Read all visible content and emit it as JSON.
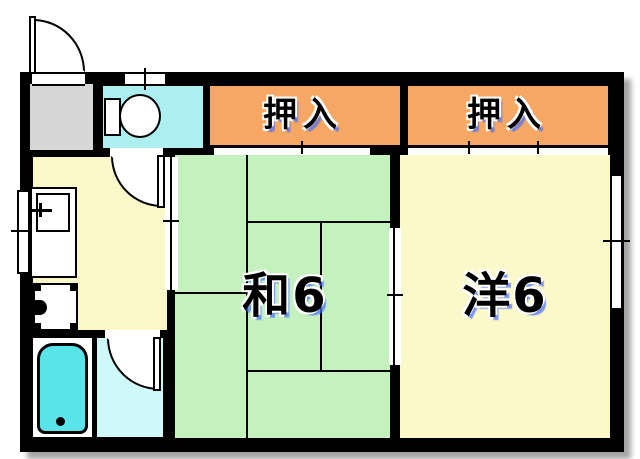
{
  "plan": {
    "type": "apartment-floor-plan",
    "labels": {
      "closet_left": "押入",
      "closet_right": "押入",
      "japanese_room": "和6",
      "western_room": "洋6"
    },
    "rooms": {
      "closet_left": {
        "label": "押入",
        "color": "#F5A763"
      },
      "closet_right": {
        "label": "押入",
        "color": "#F5A763"
      },
      "japanese_room": {
        "label": "和6",
        "color": "#C5F1BF",
        "tatami_count": 6
      },
      "western_room": {
        "label": "洋6",
        "color": "#FBF8C9"
      },
      "kitchen": {
        "color": "#FAF8C8"
      },
      "toilet_room": {
        "color": "#ADEFF1"
      },
      "washroom": {
        "color": "#CFF8F8"
      },
      "bathroom": {
        "color": "#FFFFFF"
      },
      "entry": {
        "color": "#D6D6D6"
      }
    },
    "colors": {
      "wall": "#000000",
      "bathtub": "#59E4EA",
      "label_text": "#000000",
      "label_shadow_blue": "#6E9EFF"
    },
    "fixtures": [
      "toilet",
      "bathtub",
      "kitchen-sink",
      "stove"
    ],
    "doors": {
      "hinged": [
        "entry-door",
        "toilet-door",
        "washroom-door"
      ],
      "sliding": [
        "closet-left-door",
        "closet-right-door",
        "kitchen-tatami-door",
        "tatami-western-door"
      ],
      "windows": [
        "toilet-window",
        "kitchen-window",
        "western-room-window"
      ]
    }
  }
}
